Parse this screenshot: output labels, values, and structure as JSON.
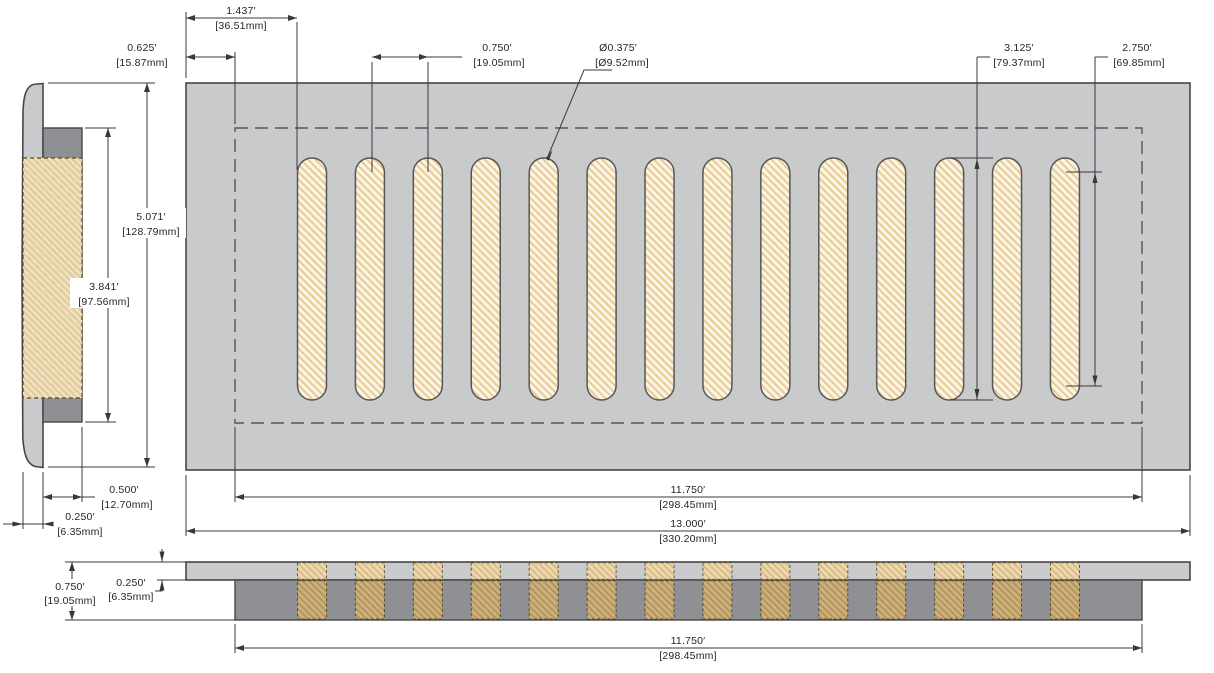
{
  "drawing": {
    "type": "technical-dimension-drawing",
    "subject": "floor vent register with 14 slots, front / side / bottom profile views",
    "slot_count": 14
  },
  "colors": {
    "faceplate_gray": "#c9cacb",
    "duct_gray": "#8e9093",
    "slot_cream": "#fbf5e6",
    "slot_hatch": "#e8cb92",
    "side_tan": "#e4cda1",
    "band_tan_light": "#ecd9b0",
    "band_tan_dark": "#cdb17c",
    "line": "#38383c",
    "background": "#ffffff"
  },
  "geometry": {
    "slot_count": 14,
    "slot_x0": 297.5,
    "slot_pitch": 57.92,
    "slot_width": 29,
    "slot_top": 158,
    "slot_height": 242,
    "slot_rx": 14.5,
    "band_top_y": 562.8,
    "band_top_h": 16.6,
    "band_bot_y": 580.8,
    "band_bot_h": 38.2
  },
  "dims": {
    "slot_offset": {
      "in": "1.437′",
      "mm": "[36.51mm]"
    },
    "border_margin": {
      "in": "0.625′",
      "mm": "[15.87mm]"
    },
    "slot_pitch": {
      "in": "0.750′",
      "mm": "[19.05mm]"
    },
    "slot_diameter": {
      "in": "Ø0.375′",
      "mm": "[Ø9.52mm]"
    },
    "slot_height": {
      "in": "3.125′",
      "mm": "[79.37mm]"
    },
    "slot_straight": {
      "in": "2.750′",
      "mm": "[69.85mm]"
    },
    "overall_height": {
      "in": "5.071′",
      "mm": "[128.79mm]"
    },
    "duct_opening_height": {
      "in": "3.841′",
      "mm": "[97.56mm]"
    },
    "duct_depth": {
      "in": "0.500′",
      "mm": "[12.70mm]"
    },
    "faceplate_thickness": {
      "in": "0.250′",
      "mm": "[6.35mm]"
    },
    "duct_width": {
      "in": "11.750′",
      "mm": "[298.45mm]"
    },
    "overall_width": {
      "in": "13.000′",
      "mm": "[330.20mm]"
    },
    "profile_total_height": {
      "in": "0.750′",
      "mm": "[19.05mm]"
    },
    "profile_flange": {
      "in": "0.250′",
      "mm": "[6.35mm]"
    },
    "profile_duct_width": {
      "in": "11.750′",
      "mm": "[298.45mm]"
    }
  }
}
